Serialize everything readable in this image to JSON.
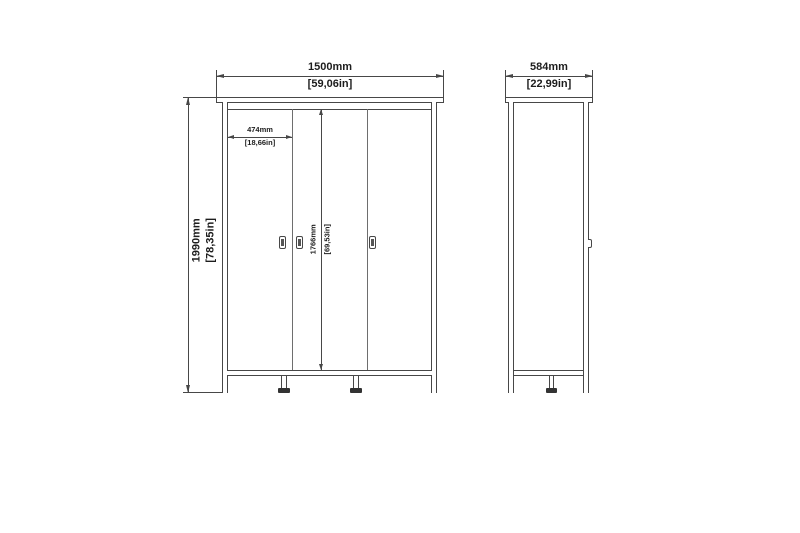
{
  "drawing": {
    "kind": "furniture dimension diagram",
    "subject": "three-door wardrobe, front and side elevation",
    "background_color": "#ffffff",
    "line_color": "#474747",
    "text_color": "#1d1d1d"
  },
  "front_view": {
    "width": {
      "mm": "1500mm",
      "in": "[59,06in]"
    },
    "height": {
      "mm": "1990mm",
      "in": "[78,35in]"
    },
    "door_width": {
      "mm": "474mm",
      "in": "[18,66in]"
    },
    "door_height": {
      "mm": "1766mm",
      "in": "[69,53in]"
    }
  },
  "side_view": {
    "depth": {
      "mm": "584mm",
      "in": "[22,99in]"
    }
  }
}
